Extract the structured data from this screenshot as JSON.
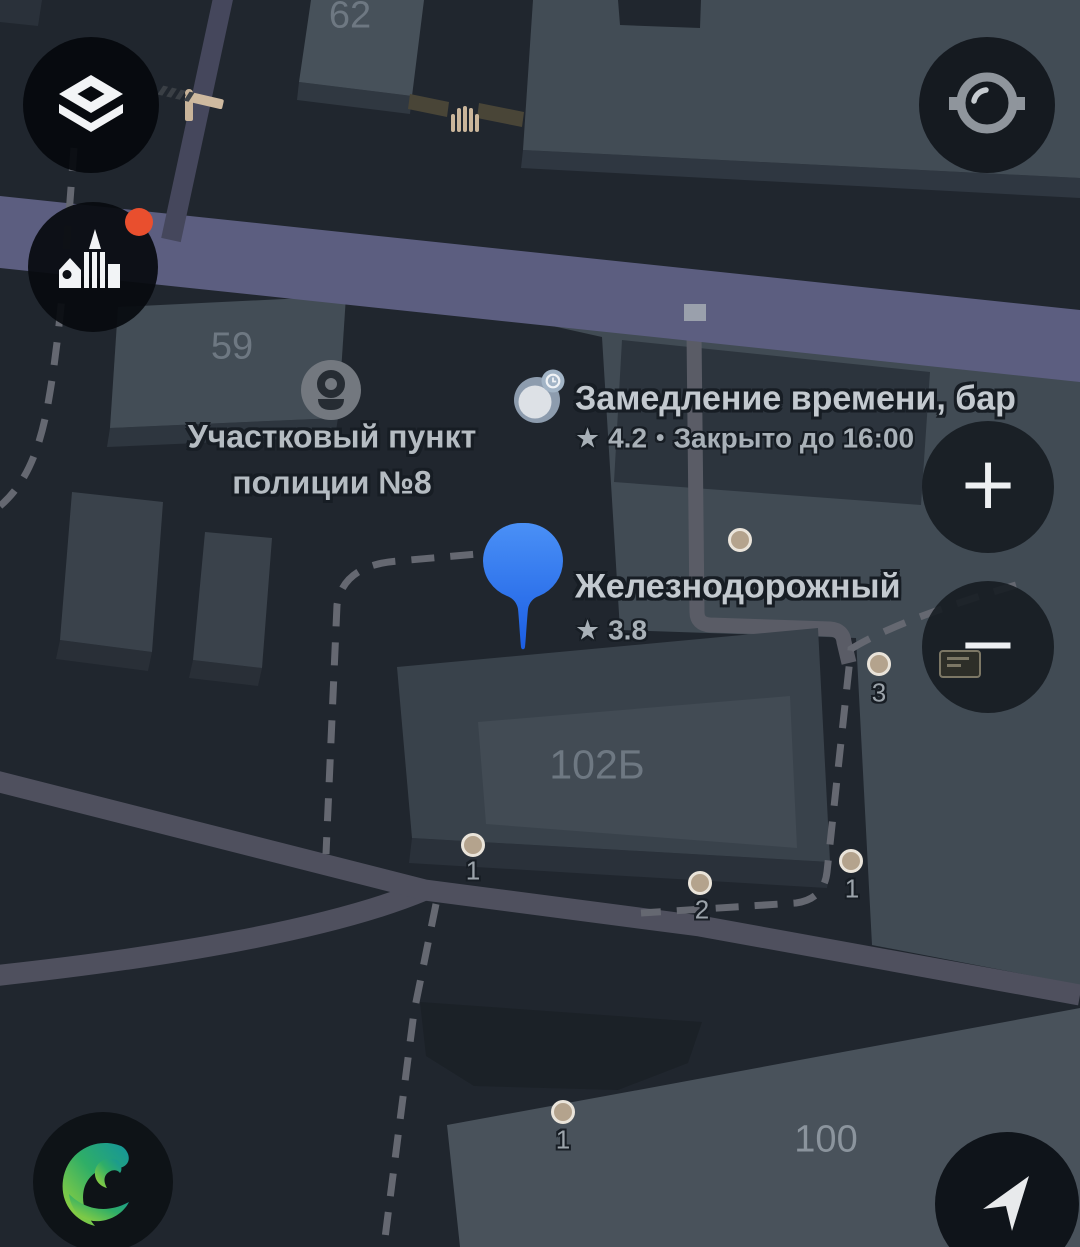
{
  "app_context": "dark-theme city map view (2GIS-style mobile map)",
  "map_labels": {
    "building_62": "62",
    "building_59": "59",
    "building_102b": "102Б",
    "building_100": "100"
  },
  "pois": {
    "police": {
      "line1": "Участковый пункт",
      "line2": "полиции №8",
      "icon": "person-icon"
    },
    "bar": {
      "name": "Замедление времени, бар",
      "star": "★",
      "rating": "4.2",
      "dot": "•",
      "status": "Закрыто до 16:00",
      "icon": "clock-badge-icon"
    },
    "selected_place": {
      "name": "Железнодорожный",
      "star": "★",
      "rating": "3.8",
      "icon": "location-pin"
    }
  },
  "entrances": [
    {
      "number": "1"
    },
    {
      "number": "2"
    },
    {
      "number": "1"
    },
    {
      "number": "3"
    },
    {
      "number": "1"
    }
  ],
  "controls": {
    "zoom_in": "+",
    "zoom_out": "−"
  },
  "icons": {
    "top_left": "layers-icon",
    "top_right": "camera-lens-icon",
    "left": "city-buildings-icon",
    "bottom_left": "2gis-logo-icon",
    "bottom_right": "navigation-arrow-icon",
    "map": [
      "barrier-icon",
      "gate-icon",
      "entrance-dot",
      "location-pin"
    ]
  },
  "colors": {
    "background": "#20262e",
    "road_primary": "#5c5e80",
    "road_secondary": "#4f505e",
    "building_light": "#424c55",
    "building_mid": "#39424b",
    "building_shadow": "#2a313a",
    "pin_blue": "#2b74ee",
    "notification_red": "#e94f2e",
    "entrance_beige": "#b4a38d",
    "logo_green": "#8ccf35",
    "logo_teal": "#14949c",
    "label_gray": "#c3c9cf"
  }
}
